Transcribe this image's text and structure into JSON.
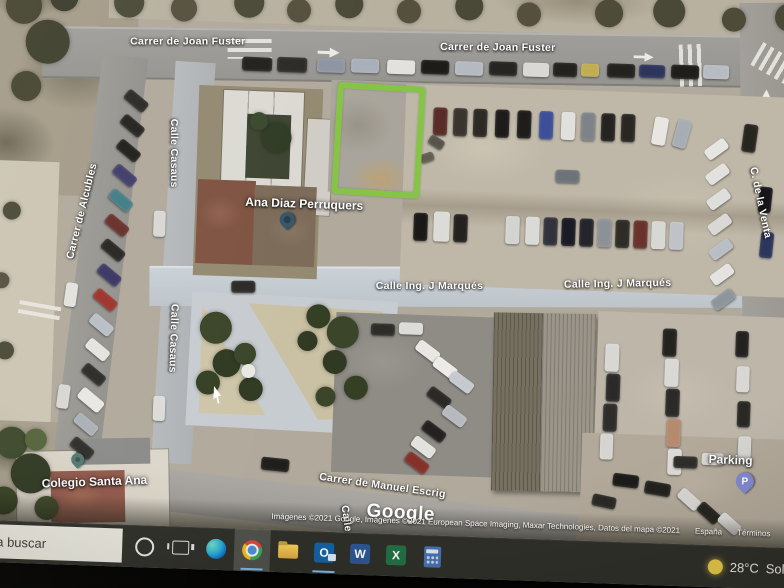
{
  "map": {
    "streets": {
      "joan_fuster": "Carrer de Joan Fuster",
      "alcubles": "Carrer de Alcubles",
      "casaus": "Calle Casaus",
      "venta": "C. de la Venta",
      "marques": "Calle Ing. J Marqués",
      "manuel_escrig": "Carrer de Manuel Escrig",
      "calle_partial": "Calle"
    },
    "pois": {
      "ana_diaz": "Ana Diaz Perruquers",
      "colegio": "Colegio Santa Ana",
      "parking": "Parking"
    },
    "pins": {
      "ana_diaz": {
        "color": "#33566b"
      },
      "colegio": {
        "color": "#527a72"
      },
      "parking": {
        "color": "#8289d6",
        "letter": "P"
      }
    },
    "highlight": {
      "color": "#82c63c"
    },
    "watermark": "Google",
    "attribution": {
      "imagery": "Imágenes ©2021 Google, Imágenes ©2021 European Space Imaging, Maxar Technologies, Datos del mapa ©2021",
      "region": "España",
      "terms": "Términos",
      "privacy": "Privaci"
    }
  },
  "taskbar": {
    "search_text": "a buscar",
    "app_letters": {
      "outlook": "O",
      "word": "W",
      "excel": "X"
    },
    "weather": {
      "temp": "28°C",
      "condition": "Sole"
    }
  },
  "map_objects": {
    "cars": [
      {
        "x": 255,
        "y": 98,
        "w": 30,
        "h": 14,
        "r": 0,
        "c": "#21201d"
      },
      {
        "x": 290,
        "y": 97,
        "w": 30,
        "h": 15,
        "r": 0,
        "c": "#2b2a26"
      },
      {
        "x": 330,
        "y": 97,
        "w": 28,
        "h": 14,
        "r": 0,
        "c": "#8d95a3"
      },
      {
        "x": 364,
        "y": 96,
        "w": 28,
        "h": 14,
        "r": 0,
        "c": "#a8b0bb"
      },
      {
        "x": 400,
        "y": 96,
        "w": 28,
        "h": 14,
        "r": 0,
        "c": "#e2e1dd"
      },
      {
        "x": 434,
        "y": 95,
        "w": 28,
        "h": 14,
        "r": 0,
        "c": "#1d1c19"
      },
      {
        "x": 468,
        "y": 95,
        "w": 28,
        "h": 14,
        "r": 0,
        "c": "#b5bac2"
      },
      {
        "x": 502,
        "y": 94,
        "w": 28,
        "h": 14,
        "r": 0,
        "c": "#262522"
      },
      {
        "x": 536,
        "y": 94,
        "w": 26,
        "h": 14,
        "r": 0,
        "c": "#d9d8d4"
      },
      {
        "x": 566,
        "y": 93,
        "w": 24,
        "h": 14,
        "r": 0,
        "c": "#23221e"
      },
      {
        "x": 594,
        "y": 93,
        "w": 18,
        "h": 13,
        "r": 0,
        "c": "#c4ad4a"
      },
      {
        "x": 620,
        "y": 92,
        "w": 28,
        "h": 14,
        "r": 0,
        "c": "#23221f"
      },
      {
        "x": 652,
        "y": 92,
        "w": 26,
        "h": 13,
        "r": 0,
        "c": "#2c3560"
      },
      {
        "x": 684,
        "y": 91,
        "w": 28,
        "h": 14,
        "r": 0,
        "c": "#1f1e1b"
      },
      {
        "x": 716,
        "y": 90,
        "w": 26,
        "h": 14,
        "r": 0,
        "c": "#b7bcc4"
      },
      {
        "x": 138,
        "y": 140,
        "w": 25,
        "h": 12,
        "r": 38,
        "c": "#2a2926"
      },
      {
        "x": 135,
        "y": 165,
        "w": 25,
        "h": 12,
        "r": 38,
        "c": "#23221f"
      },
      {
        "x": 132,
        "y": 190,
        "w": 25,
        "h": 12,
        "r": 38,
        "c": "#1f1e1b"
      },
      {
        "x": 129,
        "y": 215,
        "w": 25,
        "h": 12,
        "r": 38,
        "c": "#403c6e"
      },
      {
        "x": 126,
        "y": 240,
        "w": 25,
        "h": 12,
        "r": 38,
        "c": "#3e7d88"
      },
      {
        "x": 123,
        "y": 265,
        "w": 25,
        "h": 12,
        "r": 38,
        "c": "#6b2d28"
      },
      {
        "x": 120,
        "y": 290,
        "w": 25,
        "h": 12,
        "r": 38,
        "c": "#262522"
      },
      {
        "x": 117,
        "y": 315,
        "w": 25,
        "h": 12,
        "r": 38,
        "c": "#3a3566"
      },
      {
        "x": 114,
        "y": 340,
        "w": 25,
        "h": 12,
        "r": 38,
        "c": "#a23028"
      },
      {
        "x": 111,
        "y": 365,
        "w": 25,
        "h": 12,
        "r": 38,
        "c": "#b9bec6"
      },
      {
        "x": 108,
        "y": 390,
        "w": 25,
        "h": 12,
        "r": 38,
        "c": "#e4e3df"
      },
      {
        "x": 105,
        "y": 415,
        "w": 25,
        "h": 12,
        "r": 38,
        "c": "#2b2a27"
      },
      {
        "x": 102,
        "y": 440,
        "w": 27,
        "h": 13,
        "r": 38,
        "c": "#e8e7e3"
      },
      {
        "x": 99,
        "y": 465,
        "w": 25,
        "h": 12,
        "r": 38,
        "c": "#aab0b8"
      },
      {
        "x": 96,
        "y": 489,
        "w": 25,
        "h": 12,
        "r": 38,
        "c": "#2e2d2a"
      },
      {
        "x": 86,
        "y": 330,
        "w": 12,
        "h": 24,
        "r": 6,
        "c": "#e2e1dd"
      },
      {
        "x": 82,
        "y": 432,
        "w": 12,
        "h": 24,
        "r": 6,
        "c": "#d8d7d3"
      },
      {
        "x": 172,
        "y": 255,
        "w": 12,
        "h": 26,
        "r": 0,
        "c": "#d8d7d3"
      },
      {
        "x": 178,
        "y": 440,
        "w": 12,
        "h": 25,
        "r": 0,
        "c": "#dcdbd7"
      },
      {
        "x": 252,
        "y": 322,
        "w": 24,
        "h": 12,
        "r": -2,
        "c": "#2a2926"
      },
      {
        "x": 720,
        "y": 168,
        "w": 24,
        "h": 12,
        "r": -38,
        "c": "#e6e5e1"
      },
      {
        "x": 722,
        "y": 193,
        "w": 24,
        "h": 12,
        "r": -38,
        "c": "#e2e1dd"
      },
      {
        "x": 724,
        "y": 218,
        "w": 24,
        "h": 12,
        "r": -38,
        "c": "#dededa"
      },
      {
        "x": 726,
        "y": 243,
        "w": 24,
        "h": 12,
        "r": -38,
        "c": "#d9d8d4"
      },
      {
        "x": 728,
        "y": 268,
        "w": 24,
        "h": 12,
        "r": -38,
        "c": "#b9bec6"
      },
      {
        "x": 730,
        "y": 293,
        "w": 24,
        "h": 12,
        "r": -38,
        "c": "#e4e3df"
      },
      {
        "x": 732,
        "y": 318,
        "w": 24,
        "h": 12,
        "r": -38,
        "c": "#8f959e"
      },
      {
        "x": 758,
        "y": 148,
        "w": 14,
        "h": 28,
        "r": 6,
        "c": "#26251f"
      },
      {
        "x": 776,
        "y": 210,
        "w": 13,
        "h": 26,
        "r": 4,
        "c": "#17161a"
      },
      {
        "x": 779,
        "y": 255,
        "w": 13,
        "h": 26,
        "r": 4,
        "c": "#2c3560"
      },
      {
        "x": 448,
        "y": 142,
        "w": 14,
        "h": 28,
        "r": 0,
        "c": "#5c2b26"
      },
      {
        "x": 468,
        "y": 142,
        "w": 14,
        "h": 28,
        "r": 0,
        "c": "#3a342d"
      },
      {
        "x": 488,
        "y": 142,
        "w": 14,
        "h": 28,
        "r": 0,
        "c": "#2d2a26"
      },
      {
        "x": 510,
        "y": 142,
        "w": 14,
        "h": 28,
        "r": 0,
        "c": "#1d1c1a"
      },
      {
        "x": 532,
        "y": 142,
        "w": 14,
        "h": 28,
        "r": 0,
        "c": "#1e1d1b"
      },
      {
        "x": 554,
        "y": 142,
        "w": 14,
        "h": 28,
        "r": 0,
        "c": "#3a4f9e"
      },
      {
        "x": 576,
        "y": 142,
        "w": 14,
        "h": 28,
        "r": 0,
        "c": "#e1e0dc"
      },
      {
        "x": 596,
        "y": 142,
        "w": 14,
        "h": 28,
        "r": 0,
        "c": "#7e838b"
      },
      {
        "x": 616,
        "y": 142,
        "w": 14,
        "h": 28,
        "r": 0,
        "c": "#25231f"
      },
      {
        "x": 636,
        "y": 142,
        "w": 14,
        "h": 28,
        "r": 0,
        "c": "#2a2723"
      },
      {
        "x": 668,
        "y": 144,
        "w": 14,
        "h": 28,
        "r": 8,
        "c": "#e7e6e2"
      },
      {
        "x": 690,
        "y": 146,
        "w": 14,
        "h": 28,
        "r": 14,
        "c": "#a7adb5"
      },
      {
        "x": 572,
        "y": 200,
        "w": 24,
        "h": 13,
        "r": 0,
        "c": "#6e727a"
      },
      {
        "x": 444,
        "y": 172,
        "w": 16,
        "h": 10,
        "r": 30,
        "c": "#57534a"
      },
      {
        "x": 436,
        "y": 188,
        "w": 14,
        "h": 9,
        "r": -20,
        "c": "#615d52"
      },
      {
        "x": 432,
        "y": 248,
        "w": 14,
        "h": 28,
        "r": 0,
        "c": "#1a1917"
      },
      {
        "x": 452,
        "y": 246,
        "w": 16,
        "h": 30,
        "r": 0,
        "c": "#dcdbd7"
      },
      {
        "x": 472,
        "y": 248,
        "w": 14,
        "h": 28,
        "r": 0,
        "c": "#24221f"
      },
      {
        "x": 524,
        "y": 248,
        "w": 14,
        "h": 28,
        "r": 0,
        "c": "#d3d4d0"
      },
      {
        "x": 544,
        "y": 248,
        "w": 14,
        "h": 28,
        "r": 0,
        "c": "#dadad6"
      },
      {
        "x": 562,
        "y": 248,
        "w": 14,
        "h": 28,
        "r": 0,
        "c": "#32323e"
      },
      {
        "x": 580,
        "y": 248,
        "w": 14,
        "h": 28,
        "r": 0,
        "c": "#1a1b25"
      },
      {
        "x": 598,
        "y": 248,
        "w": 14,
        "h": 28,
        "r": 0,
        "c": "#24242c"
      },
      {
        "x": 616,
        "y": 248,
        "w": 14,
        "h": 28,
        "r": 0,
        "c": "#8c9199"
      },
      {
        "x": 634,
        "y": 248,
        "w": 14,
        "h": 28,
        "r": 0,
        "c": "#2f2c28"
      },
      {
        "x": 652,
        "y": 248,
        "w": 14,
        "h": 28,
        "r": 0,
        "c": "#6e312a"
      },
      {
        "x": 670,
        "y": 248,
        "w": 14,
        "h": 28,
        "r": 0,
        "c": "#d7d7d3"
      },
      {
        "x": 688,
        "y": 248,
        "w": 14,
        "h": 28,
        "r": 0,
        "c": "#bfc3c9"
      },
      {
        "x": 438,
        "y": 380,
        "w": 25,
        "h": 12,
        "r": 35,
        "c": "#e8e7e3"
      },
      {
        "x": 456,
        "y": 396,
        "w": 25,
        "h": 12,
        "r": 35,
        "c": "#ecebe7"
      },
      {
        "x": 473,
        "y": 410,
        "w": 25,
        "h": 12,
        "r": 35,
        "c": "#c6c9cf"
      },
      {
        "x": 451,
        "y": 426,
        "w": 25,
        "h": 12,
        "r": 35,
        "c": "#2a2926"
      },
      {
        "x": 467,
        "y": 444,
        "w": 25,
        "h": 12,
        "r": 35,
        "c": "#b6bac0"
      },
      {
        "x": 447,
        "y": 460,
        "w": 25,
        "h": 12,
        "r": 35,
        "c": "#232220"
      },
      {
        "x": 437,
        "y": 476,
        "w": 25,
        "h": 12,
        "r": 35,
        "c": "#e3e2de"
      },
      {
        "x": 431,
        "y": 492,
        "w": 25,
        "h": 12,
        "r": 35,
        "c": "#8a2f28"
      },
      {
        "x": 393,
        "y": 360,
        "w": 24,
        "h": 12,
        "r": 0,
        "c": "#2d2c29"
      },
      {
        "x": 421,
        "y": 358,
        "w": 24,
        "h": 12,
        "r": 0,
        "c": "#dcdbd7"
      },
      {
        "x": 628,
        "y": 372,
        "w": 14,
        "h": 28,
        "r": 0,
        "c": "#d8d7d3"
      },
      {
        "x": 630,
        "y": 402,
        "w": 14,
        "h": 28,
        "r": 0,
        "c": "#2b2a28"
      },
      {
        "x": 628,
        "y": 432,
        "w": 14,
        "h": 28,
        "r": 0,
        "c": "#2e2d2b"
      },
      {
        "x": 626,
        "y": 462,
        "w": 13,
        "h": 26,
        "r": 0,
        "c": "#d5d4d0"
      },
      {
        "x": 685,
        "y": 355,
        "w": 14,
        "h": 28,
        "r": 0,
        "c": "#24231f"
      },
      {
        "x": 688,
        "y": 385,
        "w": 14,
        "h": 28,
        "r": 0,
        "c": "#d9d8d4"
      },
      {
        "x": 690,
        "y": 415,
        "w": 14,
        "h": 28,
        "r": 0,
        "c": "#2b2a26"
      },
      {
        "x": 692,
        "y": 445,
        "w": 14,
        "h": 28,
        "r": 0,
        "c": "#b8896a"
      },
      {
        "x": 694,
        "y": 475,
        "w": 14,
        "h": 26,
        "r": 0,
        "c": "#dcdbd7"
      },
      {
        "x": 758,
        "y": 355,
        "w": 13,
        "h": 26,
        "r": 0,
        "c": "#23221e"
      },
      {
        "x": 760,
        "y": 390,
        "w": 13,
        "h": 26,
        "r": 0,
        "c": "#d8d7d3"
      },
      {
        "x": 762,
        "y": 425,
        "w": 13,
        "h": 26,
        "r": 0,
        "c": "#292824"
      },
      {
        "x": 764,
        "y": 460,
        "w": 13,
        "h": 26,
        "r": 0,
        "c": "#d6d5d1"
      },
      {
        "x": 640,
        "y": 502,
        "w": 26,
        "h": 13,
        "r": 5,
        "c": "#1c1b19"
      },
      {
        "x": 672,
        "y": 509,
        "w": 26,
        "h": 13,
        "r": 8,
        "c": "#23221e"
      },
      {
        "x": 705,
        "y": 519,
        "w": 24,
        "h": 12,
        "r": 40,
        "c": "#d9d8d4"
      },
      {
        "x": 725,
        "y": 532,
        "w": 24,
        "h": 12,
        "r": 40,
        "c": "#26251f"
      },
      {
        "x": 746,
        "y": 542,
        "w": 24,
        "h": 12,
        "r": 40,
        "c": "#dcdbd7"
      },
      {
        "x": 620,
        "y": 524,
        "w": 24,
        "h": 12,
        "r": 10,
        "c": "#2a2925"
      },
      {
        "x": 700,
        "y": 482,
        "w": 24,
        "h": 12,
        "r": 0,
        "c": "#2e2d29"
      },
      {
        "x": 728,
        "y": 478,
        "w": 22,
        "h": 12,
        "r": 0,
        "c": "#d8d7d3"
      },
      {
        "x": 288,
        "y": 498,
        "w": 28,
        "h": 13,
        "r": 4,
        "c": "#1f1e1b"
      }
    ],
    "trees": [
      {
        "x": 238,
        "y": 370,
        "d": 32,
        "c": "#3a4527"
      },
      {
        "x": 250,
        "y": 405,
        "d": 28,
        "c": "#2f3a20"
      },
      {
        "x": 232,
        "y": 425,
        "d": 24,
        "c": "#333f22"
      },
      {
        "x": 268,
        "y": 395,
        "d": 22,
        "c": "#3a4527"
      },
      {
        "x": 275,
        "y": 430,
        "d": 24,
        "c": "#2f3a20"
      },
      {
        "x": 340,
        "y": 355,
        "d": 24,
        "c": "#333f22"
      },
      {
        "x": 365,
        "y": 370,
        "d": 32,
        "c": "#3a4527"
      },
      {
        "x": 358,
        "y": 400,
        "d": 24,
        "c": "#2f3a20"
      },
      {
        "x": 380,
        "y": 425,
        "d": 24,
        "c": "#333f22"
      },
      {
        "x": 350,
        "y": 435,
        "d": 20,
        "c": "#3a4527"
      },
      {
        "x": 330,
        "y": 380,
        "d": 20,
        "c": "#2f3a20"
      },
      {
        "x": 272,
        "y": 412,
        "d": 14,
        "c": "#eae8e1"
      },
      {
        "x": 35,
        "y": 55,
        "d": 36,
        "c": "#46452f"
      },
      {
        "x": 60,
        "y": 90,
        "d": 44,
        "c": "#3f3f2c"
      },
      {
        "x": 40,
        "y": 135,
        "d": 30,
        "c": "#45452f"
      },
      {
        "x": 75,
        "y": 45,
        "d": 28,
        "c": "#3c3c2a"
      },
      {
        "x": 25,
        "y": 20,
        "d": 32,
        "c": "#44442e"
      },
      {
        "x": 95,
        "y": 20,
        "d": 28,
        "c": "#3f3f2c"
      },
      {
        "x": 140,
        "y": 48,
        "d": 30,
        "c": "#4a4936"
      },
      {
        "x": 195,
        "y": 52,
        "d": 26,
        "c": "#55503c"
      },
      {
        "x": 260,
        "y": 44,
        "d": 30,
        "c": "#4a4936"
      },
      {
        "x": 310,
        "y": 50,
        "d": 24,
        "c": "#55503c"
      },
      {
        "x": 360,
        "y": 42,
        "d": 28,
        "c": "#4a4936"
      },
      {
        "x": 420,
        "y": 47,
        "d": 24,
        "c": "#55503c"
      },
      {
        "x": 480,
        "y": 40,
        "d": 28,
        "c": "#4a4936"
      },
      {
        "x": 540,
        "y": 46,
        "d": 24,
        "c": "#55503c"
      },
      {
        "x": 620,
        "y": 42,
        "d": 28,
        "c": "#4f4b38"
      },
      {
        "x": 680,
        "y": 38,
        "d": 32,
        "c": "#4a4936"
      },
      {
        "x": 745,
        "y": 44,
        "d": 24,
        "c": "#4f4b38"
      },
      {
        "x": 800,
        "y": 40,
        "d": 28,
        "c": "#4a4936"
      },
      {
        "x": 38,
        "y": 492,
        "d": 32,
        "c": "#3d4a2a"
      },
      {
        "x": 58,
        "y": 522,
        "d": 40,
        "c": "#2f3a20"
      },
      {
        "x": 32,
        "y": 550,
        "d": 28,
        "c": "#36421f"
      },
      {
        "x": 75,
        "y": 556,
        "d": 24,
        "c": "#3f4b26"
      },
      {
        "x": 62,
        "y": 488,
        "d": 22,
        "c": "#55663a"
      },
      {
        "x": 292,
        "y": 178,
        "d": 30,
        "c": "#2e3b22"
      },
      {
        "x": 274,
        "y": 162,
        "d": 18,
        "c": "#39482b"
      },
      {
        "x": 30,
        "y": 260,
        "d": 18,
        "c": "#4a4936"
      },
      {
        "x": 22,
        "y": 330,
        "d": 16,
        "c": "#55503c"
      },
      {
        "x": 28,
        "y": 400,
        "d": 18,
        "c": "#4a4936"
      }
    ]
  }
}
